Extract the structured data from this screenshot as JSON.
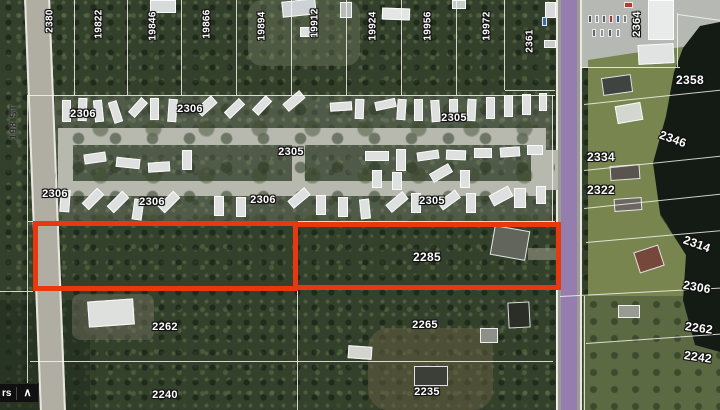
{
  "ui": {
    "layers_label_fragment": "rs",
    "collapse_icon": "∧"
  },
  "map": {
    "street_label": {
      "text": "198 ST"
    },
    "highlight_color": "#e8380f",
    "building_default_color": "#dde0de",
    "highlights": [
      {
        "name": "parcel-highlight-west",
        "x": 33,
        "y": 221,
        "w": 265,
        "h": 70
      },
      {
        "name": "parcel-highlight-east",
        "x": 293,
        "y": 222,
        "w": 268,
        "h": 68
      }
    ],
    "labels": [
      {
        "t": "2380",
        "x": 50,
        "y": 21,
        "r": -90,
        "s": 10
      },
      {
        "t": "19822",
        "x": 99,
        "y": 24,
        "r": -90,
        "s": 10
      },
      {
        "t": "19846",
        "x": 153,
        "y": 26,
        "r": -90,
        "s": 10
      },
      {
        "t": "19866",
        "x": 207,
        "y": 24,
        "r": -90,
        "s": 10
      },
      {
        "t": "19894",
        "x": 262,
        "y": 26,
        "r": -90,
        "s": 10
      },
      {
        "t": "19912",
        "x": 315,
        "y": 23,
        "r": -90,
        "s": 10
      },
      {
        "t": "19924",
        "x": 373,
        "y": 26,
        "r": -90,
        "s": 10
      },
      {
        "t": "19956",
        "x": 428,
        "y": 26,
        "r": -90,
        "s": 10
      },
      {
        "t": "19972",
        "x": 487,
        "y": 26,
        "r": -90,
        "s": 10
      },
      {
        "t": "2361",
        "x": 530,
        "y": 41,
        "r": -90,
        "s": 10
      },
      {
        "t": "2364",
        "x": 637,
        "y": 24,
        "r": -90,
        "s": 11
      },
      {
        "t": "2358",
        "x": 690,
        "y": 80,
        "r": 0,
        "s": 12
      },
      {
        "t": "2346",
        "x": 673,
        "y": 139,
        "r": 20,
        "s": 12
      },
      {
        "t": "2334",
        "x": 601,
        "y": 157,
        "r": 0,
        "s": 12
      },
      {
        "t": "2322",
        "x": 601,
        "y": 190,
        "r": 0,
        "s": 12
      },
      {
        "t": "2314",
        "x": 697,
        "y": 244,
        "r": 20,
        "s": 12
      },
      {
        "t": "2306",
        "x": 697,
        "y": 287,
        "r": 10,
        "s": 12
      },
      {
        "t": "2262",
        "x": 699,
        "y": 328,
        "r": 8,
        "s": 12
      },
      {
        "t": "2242",
        "x": 698,
        "y": 357,
        "r": 8,
        "s": 12
      },
      {
        "t": "2306",
        "x": 83,
        "y": 114,
        "r": 0,
        "s": 11
      },
      {
        "t": "2306",
        "x": 190,
        "y": 109,
        "r": 0,
        "s": 11
      },
      {
        "t": "2305",
        "x": 291,
        "y": 152,
        "r": 0,
        "s": 11
      },
      {
        "t": "2305",
        "x": 454,
        "y": 118,
        "r": 0,
        "s": 11
      },
      {
        "t": "2306",
        "x": 55,
        "y": 194,
        "r": 0,
        "s": 11
      },
      {
        "t": "2306",
        "x": 152,
        "y": 202,
        "r": 0,
        "s": 11
      },
      {
        "t": "2306",
        "x": 263,
        "y": 200,
        "r": 0,
        "s": 11
      },
      {
        "t": "2305",
        "x": 432,
        "y": 201,
        "r": 0,
        "s": 11
      },
      {
        "t": "2285",
        "x": 427,
        "y": 257,
        "r": 0,
        "s": 12
      },
      {
        "t": "2262",
        "x": 165,
        "y": 327,
        "r": 0,
        "s": 11
      },
      {
        "t": "2265",
        "x": 425,
        "y": 325,
        "r": 0,
        "s": 11
      },
      {
        "t": "2240",
        "x": 165,
        "y": 395,
        "r": 0,
        "s": 11
      },
      {
        "t": "2235",
        "x": 427,
        "y": 392,
        "r": 0,
        "s": 11
      }
    ],
    "boundaries": [
      [
        28,
        95,
        527,
        0
      ],
      [
        75,
        0,
        95,
        90
      ],
      [
        128,
        0,
        95,
        90
      ],
      [
        182,
        0,
        95,
        90
      ],
      [
        237,
        0,
        95,
        90
      ],
      [
        292,
        0,
        95,
        90
      ],
      [
        347,
        0,
        95,
        90
      ],
      [
        402,
        0,
        95,
        90
      ],
      [
        457,
        0,
        95,
        90
      ],
      [
        505,
        0,
        90,
        90
      ],
      [
        505,
        90,
        50,
        0
      ],
      [
        553,
        95,
        127,
        90
      ],
      [
        28,
        95,
        290,
        90
      ],
      [
        28,
        221,
        527,
        0
      ],
      [
        0,
        291,
        33,
        0
      ],
      [
        30,
        361,
        523,
        0
      ],
      [
        298,
        290,
        120,
        90
      ],
      [
        557,
        222,
        188,
        90
      ],
      [
        560,
        296,
        162,
        -3
      ],
      [
        584,
        104,
        140,
        -6
      ],
      [
        584,
        170,
        140,
        -6
      ],
      [
        584,
        208,
        140,
        -6
      ],
      [
        586,
        242,
        136,
        -5
      ],
      [
        586,
        343,
        136,
        -4
      ],
      [
        580,
        67,
        100,
        0
      ],
      [
        678,
        13,
        54,
        90
      ],
      [
        678,
        14,
        44,
        8
      ],
      [
        585,
        296,
        114,
        90
      ]
    ],
    "buildings": [
      [
        62,
        100,
        9,
        22,
        0,
        null
      ],
      [
        78,
        98,
        9,
        23,
        2,
        null
      ],
      [
        94,
        100,
        9,
        22,
        -6,
        null
      ],
      [
        111,
        101,
        9,
        22,
        -18,
        null
      ],
      [
        128,
        103,
        20,
        9,
        -48,
        null
      ],
      [
        150,
        98,
        9,
        22,
        0,
        null
      ],
      [
        168,
        99,
        9,
        23,
        4,
        null
      ],
      [
        196,
        101,
        21,
        10,
        -42,
        null
      ],
      [
        224,
        104,
        21,
        9,
        -44,
        null
      ],
      [
        252,
        101,
        20,
        9,
        -46,
        null
      ],
      [
        283,
        96,
        22,
        10,
        -40,
        null
      ],
      [
        330,
        102,
        22,
        9,
        -4,
        null
      ],
      [
        355,
        99,
        9,
        20,
        2,
        null
      ],
      [
        375,
        100,
        21,
        9,
        -12,
        null
      ],
      [
        397,
        99,
        9,
        21,
        4,
        null
      ],
      [
        414,
        99,
        9,
        22,
        0,
        null
      ],
      [
        431,
        100,
        9,
        22,
        -4,
        null
      ],
      [
        449,
        99,
        9,
        22,
        0,
        null
      ],
      [
        467,
        99,
        9,
        22,
        3,
        null
      ],
      [
        486,
        97,
        9,
        22,
        0,
        null
      ],
      [
        504,
        95,
        9,
        22,
        0,
        null
      ],
      [
        522,
        94,
        9,
        21,
        0,
        null
      ],
      [
        539,
        93,
        8,
        18,
        0,
        null
      ],
      [
        84,
        153,
        22,
        10,
        -8,
        null
      ],
      [
        116,
        158,
        24,
        10,
        6,
        null
      ],
      [
        148,
        162,
        22,
        10,
        -4,
        null
      ],
      [
        182,
        150,
        10,
        20,
        0,
        null
      ],
      [
        365,
        151,
        24,
        10,
        0,
        null
      ],
      [
        396,
        149,
        10,
        22,
        0,
        null
      ],
      [
        417,
        151,
        22,
        9,
        -8,
        null
      ],
      [
        446,
        150,
        20,
        10,
        2,
        null
      ],
      [
        474,
        148,
        18,
        10,
        0,
        null
      ],
      [
        500,
        147,
        20,
        10,
        -4,
        null
      ],
      [
        527,
        145,
        16,
        10,
        0,
        null
      ],
      [
        372,
        170,
        10,
        18,
        0,
        null
      ],
      [
        392,
        172,
        10,
        18,
        0,
        null
      ],
      [
        430,
        168,
        22,
        10,
        -30,
        null
      ],
      [
        460,
        170,
        10,
        18,
        0,
        null
      ],
      [
        60,
        190,
        10,
        22,
        4,
        null
      ],
      [
        82,
        194,
        22,
        10,
        -45,
        null
      ],
      [
        107,
        197,
        22,
        10,
        -45,
        null
      ],
      [
        133,
        199,
        10,
        21,
        8,
        null
      ],
      [
        158,
        197,
        22,
        10,
        -45,
        null
      ],
      [
        214,
        196,
        10,
        20,
        0,
        null
      ],
      [
        236,
        197,
        10,
        20,
        0,
        null
      ],
      [
        288,
        193,
        22,
        10,
        -40,
        null
      ],
      [
        316,
        195,
        10,
        20,
        0,
        null
      ],
      [
        338,
        197,
        10,
        20,
        0,
        null
      ],
      [
        360,
        199,
        10,
        20,
        -6,
        null
      ],
      [
        386,
        197,
        22,
        10,
        -40,
        null
      ],
      [
        411,
        193,
        10,
        20,
        0,
        null
      ],
      [
        438,
        195,
        22,
        10,
        -36,
        null
      ],
      [
        466,
        193,
        10,
        20,
        0,
        null
      ],
      [
        490,
        190,
        22,
        12,
        -28,
        null
      ],
      [
        514,
        188,
        12,
        20,
        0,
        null
      ],
      [
        536,
        186,
        10,
        18,
        0,
        null
      ],
      [
        150,
        0,
        26,
        13,
        0,
        "#d8dbdb"
      ],
      [
        282,
        0,
        34,
        16,
        -6,
        "#cdd2d4"
      ],
      [
        300,
        27,
        16,
        10,
        0,
        "#dfe1e1"
      ],
      [
        340,
        2,
        12,
        16,
        0,
        "#b9bdb9"
      ],
      [
        382,
        8,
        28,
        12,
        2,
        "#e4e6e6"
      ],
      [
        452,
        0,
        14,
        9,
        0,
        "#c8ccc8"
      ],
      [
        545,
        2,
        11,
        16,
        0,
        "#d8dada"
      ],
      [
        544,
        40,
        12,
        8,
        0,
        "#caccca"
      ],
      [
        542,
        17,
        5,
        9,
        0,
        "#3a6aa8"
      ],
      [
        648,
        0,
        26,
        40,
        0,
        "#e9ebea"
      ],
      [
        638,
        44,
        36,
        20,
        -3,
        "#e0e3e1"
      ],
      [
        624,
        2,
        9,
        6,
        0,
        "#a84034"
      ],
      [
        588,
        15,
        4,
        8,
        0,
        "#4a5258"
      ],
      [
        595,
        15,
        4,
        8,
        0,
        "#8a9097"
      ],
      [
        602,
        15,
        4,
        8,
        0,
        "#5a6268"
      ],
      [
        609,
        15,
        4,
        8,
        0,
        "#9a3a32"
      ],
      [
        616,
        15,
        4,
        8,
        0,
        "#3a5a8a"
      ],
      [
        623,
        15,
        4,
        8,
        0,
        "#777d82"
      ],
      [
        592,
        29,
        4,
        8,
        0,
        "#60686e"
      ],
      [
        600,
        29,
        4,
        8,
        0,
        "#8d9398"
      ],
      [
        608,
        29,
        4,
        8,
        0,
        "#50585e"
      ],
      [
        616,
        29,
        4,
        8,
        0,
        "#868c91"
      ],
      [
        602,
        76,
        30,
        18,
        -8,
        "#3f4440"
      ],
      [
        616,
        104,
        26,
        18,
        -10,
        "#d4d7d0"
      ],
      [
        610,
        165,
        30,
        15,
        -4,
        "#59544e"
      ],
      [
        614,
        198,
        28,
        13,
        -4,
        "#6b665f"
      ],
      [
        636,
        248,
        26,
        22,
        -18,
        "#76483c"
      ],
      [
        618,
        305,
        22,
        13,
        0,
        "#989b92"
      ],
      [
        492,
        228,
        36,
        30,
        10,
        "#62655c"
      ],
      [
        88,
        300,
        46,
        26,
        -4,
        "#dde0dc"
      ],
      [
        508,
        302,
        22,
        26,
        -3,
        "#2b2e26"
      ],
      [
        480,
        328,
        18,
        15,
        0,
        "#8d9088"
      ],
      [
        348,
        346,
        24,
        13,
        4,
        "#d2d5cf"
      ],
      [
        414,
        366,
        34,
        20,
        0,
        "#3b3f37"
      ]
    ]
  }
}
